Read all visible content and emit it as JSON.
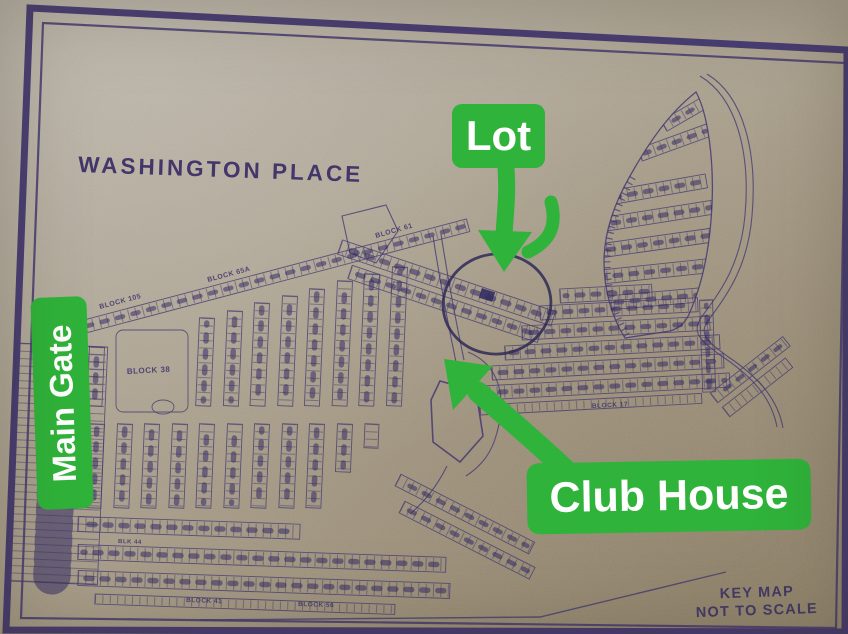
{
  "photo": {
    "title": "WASHINGTON PLACE",
    "annotations": {
      "lot": "Lot",
      "main_gate": "Main Gate",
      "club_house": "Club House"
    },
    "footer": {
      "key_map": "KEY MAP",
      "not_to_scale": "NOT TO SCALE"
    },
    "blocks": {
      "b105": "BLOCK 105",
      "b65a": "BLOCK 65A",
      "b61": "BLOCK 61",
      "b38": "BLOCK 38",
      "b44": "BLK 44",
      "b41": "BLOCK 41",
      "b56": "BLOCK 56",
      "b17": "BLOCK 17"
    },
    "colors": {
      "paper": "#a89d89",
      "ink": "#3f356e",
      "annotation_green": "#2fb33a",
      "annotation_text": "#ffffff"
    }
  }
}
